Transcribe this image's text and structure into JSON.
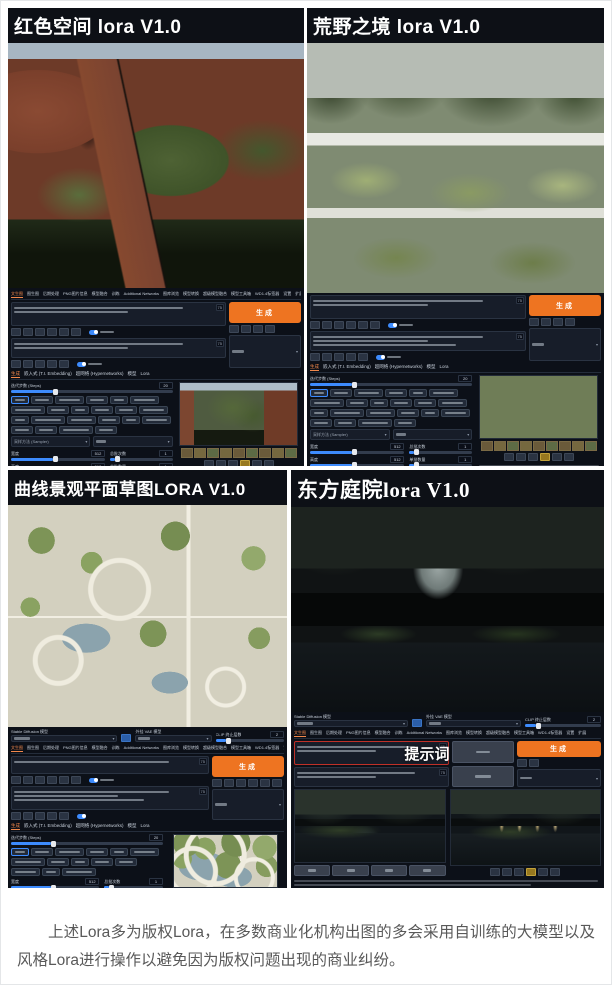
{
  "article": {
    "paragraph": "上述Lora多为版权Lora，在多数商业化机构出图的多会采用自训练的大模型以及风格Lora进行操作以避免因为版权问题出现的商业纠纷。"
  },
  "panels": [
    {
      "title": "红色空间 lora V1.0"
    },
    {
      "title": "荒野之境 lora V1.0"
    },
    {
      "title": "曲线景观平面草图LORA V1.0"
    },
    {
      "title": "东方庭院lora V1.0"
    }
  ],
  "webui": {
    "top_tabs": [
      "文生图",
      "图生图",
      "后期处理",
      "PNG图片信息",
      "模型融合",
      "训练",
      "Additional Networks",
      "图库浏览",
      "模型转换",
      "超级模型融合",
      "模型工具箱",
      "WD1.4标签器",
      "设置",
      "扩展"
    ],
    "sub_tabs": [
      "生成",
      "嵌入式 (T.I. Embedding)",
      "超网络 (Hypernetworks)",
      "模型",
      "Lora"
    ],
    "generate_label": "生成",
    "prompt_annotation": "提示词",
    "token_counter": "75",
    "checkpoint_label": "Stable Diffusion 模型",
    "vae_label": "外挂 VAE 模型",
    "clip_label": "CLIP 终止层数",
    "clip_value": "2",
    "steps_label": "迭代步数 (Steps)",
    "steps_value": "20",
    "sampler_label": "采样方法 (Sampler)",
    "width_label": "宽度",
    "width_value": "512",
    "height_label": "高度",
    "height_value": "512",
    "batch_count_label": "总批次数",
    "batch_count_value": "1",
    "batch_size_label": "单批数量",
    "batch_size_value": "1",
    "cfg_label": "提示词引导系数 (CFG Scale)",
    "cfg_value": "7",
    "seed_label": "随机数种子 (Seed)",
    "seed_value": "-1",
    "save_buttons": [
      "保存",
      "打包下载",
      "发送到图生图",
      "发送到局部重绘",
      "发送到后期处理"
    ],
    "colors": {
      "accent_orange": "#ee7421",
      "slider_blue": "#3d8bfd",
      "ui_background": "#0c1018",
      "prompt_highlight_red": "#c03028"
    }
  }
}
